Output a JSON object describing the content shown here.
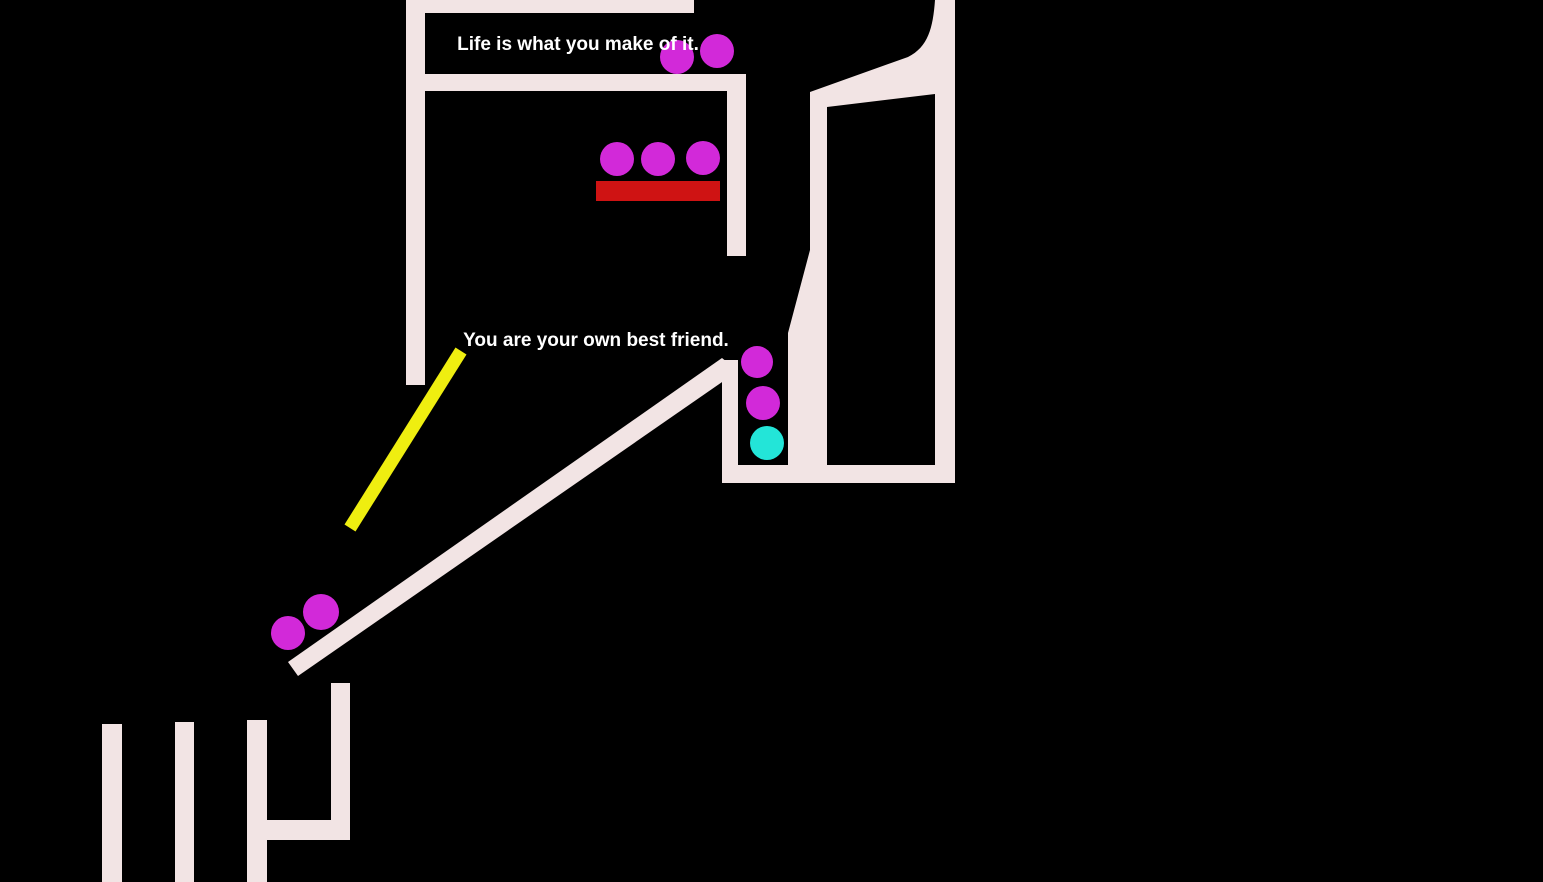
{
  "app": {
    "type": "physics-drawing-game",
    "background": "#000000"
  },
  "quotes": [
    {
      "text": "Life is what you make of it.",
      "x": 578,
      "y": 50
    },
    {
      "text": "You are your own best friend.",
      "x": 596,
      "y": 346
    }
  ],
  "colors": {
    "background": "#000000",
    "wall": "#f2e4e4",
    "magenta_ball": "#d229d9",
    "cyan_ball": "#23e5d8",
    "red_block": "#cf1313",
    "yellow_line": "#efee10",
    "quote_text": "#ffffff"
  },
  "balls": [
    {
      "x": 677,
      "y": 57,
      "r": 17,
      "color": "magenta_ball"
    },
    {
      "x": 717,
      "y": 51,
      "r": 17,
      "color": "magenta_ball"
    },
    {
      "x": 617,
      "y": 159,
      "r": 17,
      "color": "magenta_ball"
    },
    {
      "x": 658,
      "y": 159,
      "r": 17,
      "color": "magenta_ball"
    },
    {
      "x": 703,
      "y": 158,
      "r": 17,
      "color": "magenta_ball"
    },
    {
      "x": 757,
      "y": 362,
      "r": 16,
      "color": "magenta_ball"
    },
    {
      "x": 763,
      "y": 403,
      "r": 17,
      "color": "magenta_ball"
    },
    {
      "x": 767,
      "y": 443,
      "r": 17,
      "color": "cyan_ball"
    },
    {
      "x": 288,
      "y": 633,
      "r": 17,
      "color": "magenta_ball"
    },
    {
      "x": 321,
      "y": 612,
      "r": 18,
      "color": "magenta_ball"
    }
  ],
  "red_block": {
    "x": 596,
    "y": 181,
    "width": 124,
    "height": 20
  },
  "yellow_line": {
    "x1": 461,
    "y1": 351,
    "x2": 350,
    "y2": 528,
    "stroke_width": 13
  }
}
